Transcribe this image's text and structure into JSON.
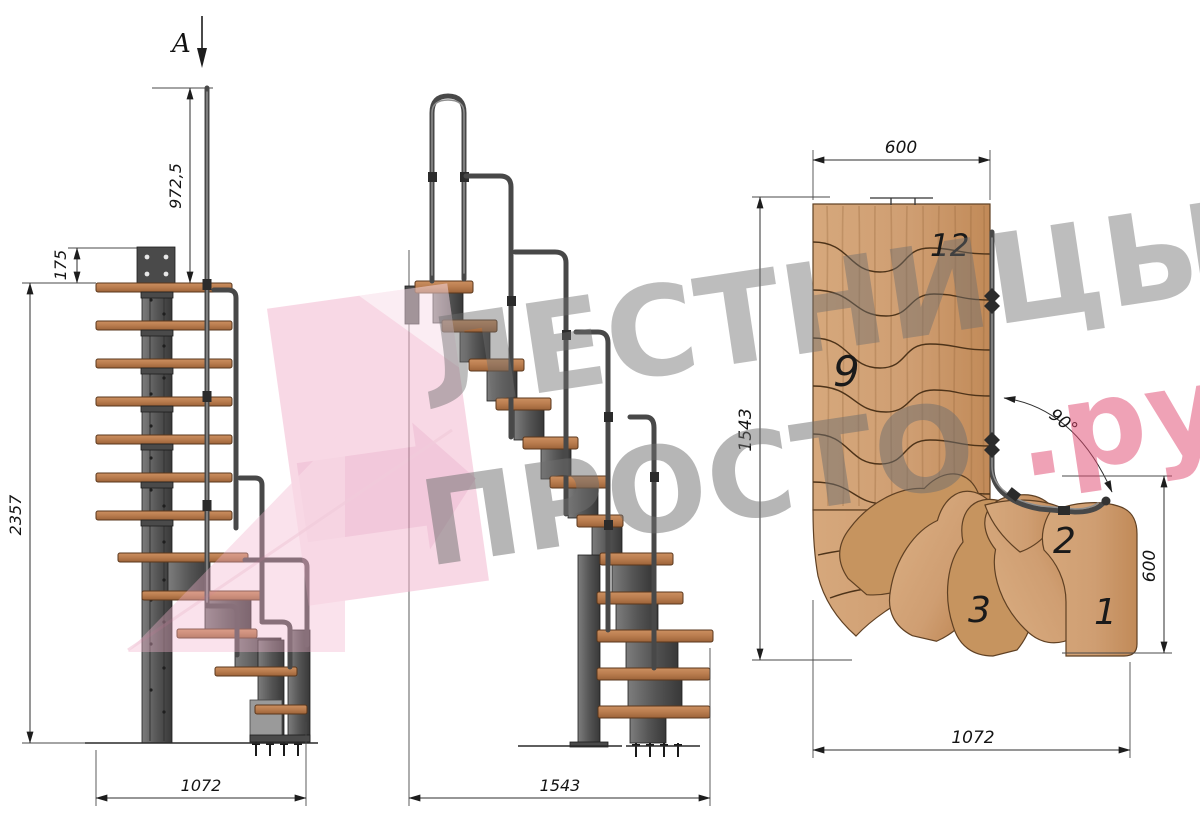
{
  "drawing": {
    "section_label": "A",
    "side_view": {
      "dim_rail_height": "972,5",
      "dim_top_offset": "175",
      "dim_total_height": "2357",
      "dim_depth": "1072"
    },
    "front_view": {
      "dim_width": "1543"
    },
    "plan_view": {
      "dim_top_width": "600",
      "dim_length": "1543",
      "dim_angle": "90°",
      "dim_entry_width": "600",
      "dim_bottom_width": "1072",
      "step_top": "12",
      "step_mid": "9",
      "step_2": "2",
      "step_3": "3",
      "step_1": "1"
    },
    "watermark": {
      "line1": "ЛЕСТНИЦЫ",
      "line2": "ПРОСТО",
      "suffix": ".ру"
    },
    "colors": {
      "wood": "#b97c4e",
      "plan_wood": "#cf9e72",
      "metal": "#555555",
      "logo_pink": "#f2b3cc",
      "accent_pink": "#e0476f",
      "watermark_gray": "#6f6f6f"
    }
  }
}
